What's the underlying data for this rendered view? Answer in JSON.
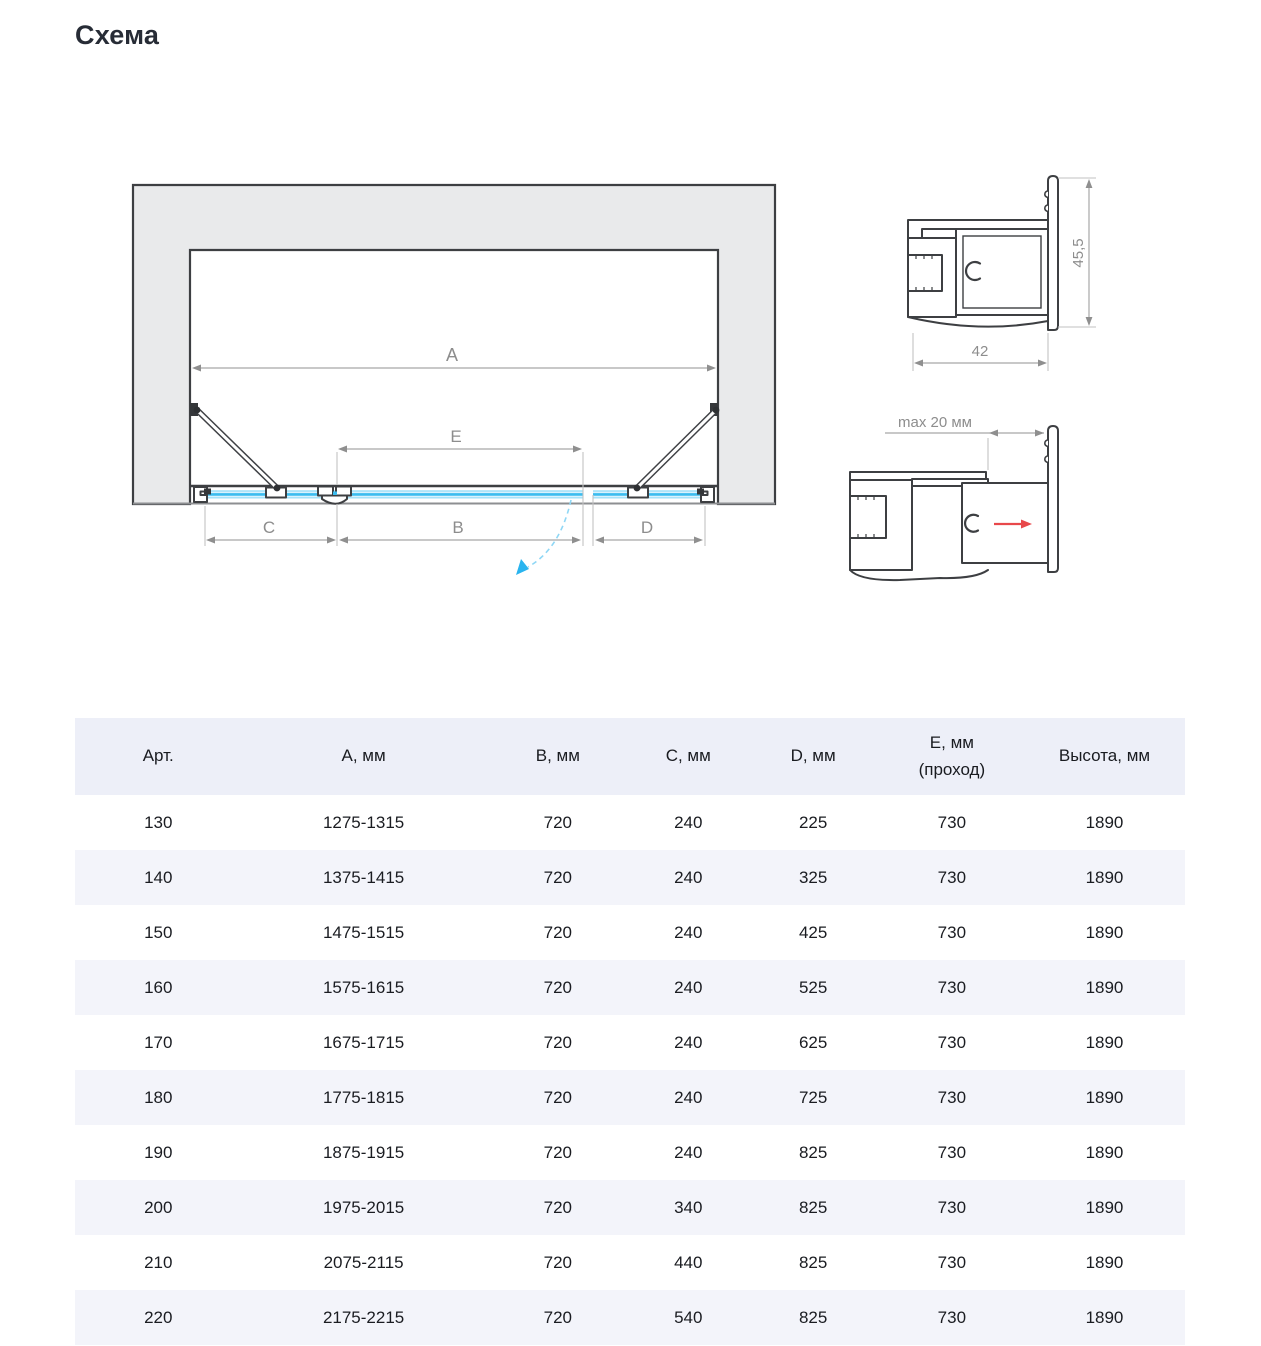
{
  "page": {
    "title": "Схема"
  },
  "diagram": {
    "dimension_labels": {
      "a": "A",
      "b": "B",
      "c": "C",
      "d": "D",
      "e": "E"
    },
    "profile_top": {
      "width": "42",
      "height": "45,5"
    },
    "profile_bottom": {
      "max_gap": "max 20 мм"
    },
    "colors": {
      "glass_blue": "#3bbcef",
      "swing_arc_blue": "#8fd7f5",
      "swing_arrow_blue": "#29b4ef",
      "arrow_red": "#e8484b",
      "wall_fill": "#e9eaeb",
      "outline": "#3d3f42",
      "dimension_gray": "#8f8f8f"
    }
  },
  "table": {
    "columns": [
      {
        "label": "Арт."
      },
      {
        "label": "A, мм"
      },
      {
        "label": "B, мм"
      },
      {
        "label": "C, мм"
      },
      {
        "label": "D, мм"
      },
      {
        "label": "E, мм",
        "label2": "(проход)"
      },
      {
        "label": "Высота, мм"
      }
    ],
    "rows": [
      [
        "130",
        "1275-1315",
        "720",
        "240",
        "225",
        "730",
        "1890"
      ],
      [
        "140",
        "1375-1415",
        "720",
        "240",
        "325",
        "730",
        "1890"
      ],
      [
        "150",
        "1475-1515",
        "720",
        "240",
        "425",
        "730",
        "1890"
      ],
      [
        "160",
        "1575-1615",
        "720",
        "240",
        "525",
        "730",
        "1890"
      ],
      [
        "170",
        "1675-1715",
        "720",
        "240",
        "625",
        "730",
        "1890"
      ],
      [
        "180",
        "1775-1815",
        "720",
        "240",
        "725",
        "730",
        "1890"
      ],
      [
        "190",
        "1875-1915",
        "720",
        "240",
        "825",
        "730",
        "1890"
      ],
      [
        "200",
        "1975-2015",
        "720",
        "340",
        "825",
        "730",
        "1890"
      ],
      [
        "210",
        "2075-2115",
        "720",
        "440",
        "825",
        "730",
        "1890"
      ],
      [
        "220",
        "2175-2215",
        "720",
        "540",
        "825",
        "730",
        "1890"
      ]
    ]
  }
}
